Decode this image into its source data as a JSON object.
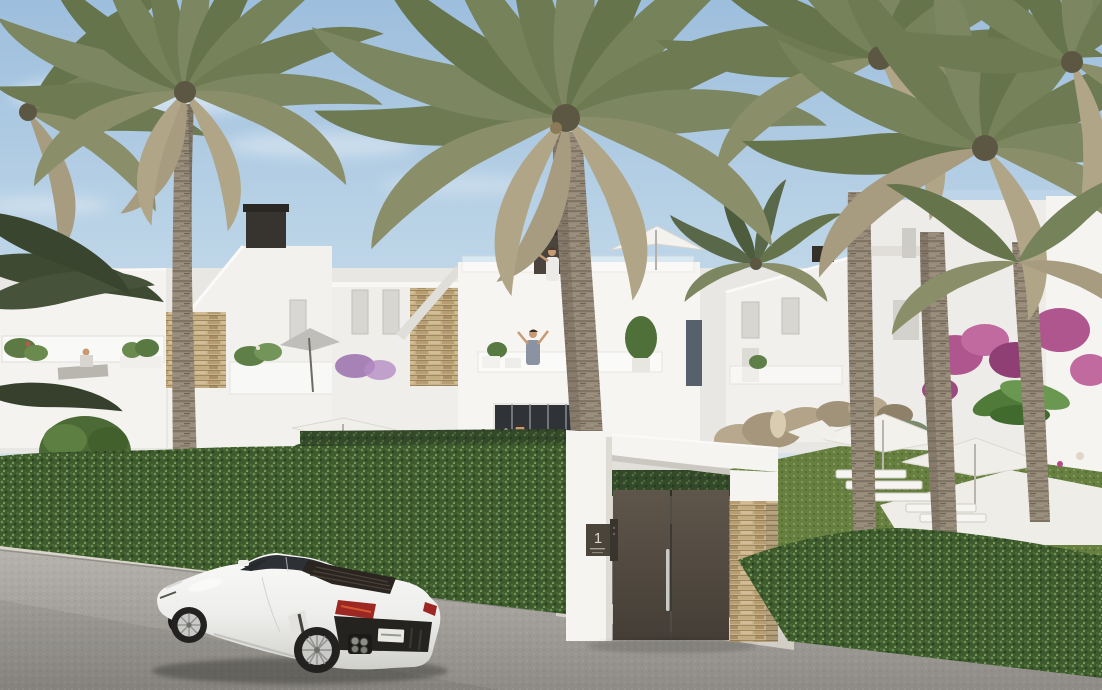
{
  "scene": {
    "kind": "residential-exterior-render",
    "objects": [
      "sky",
      "clouds",
      "palm-trees",
      "white-townhouses",
      "roof-terraces",
      "balconies",
      "street-hedge",
      "entrance-gate",
      "stone-pillar",
      "garden-with-umbrellas",
      "lawn",
      "bougainvillea",
      "road",
      "curb",
      "white-sports-car",
      "people-on-terraces"
    ]
  },
  "gate": {
    "plaque_number": "1"
  },
  "car": {
    "color_label": "white",
    "type_label": "sports-coupe"
  },
  "palette": {
    "sky_top": "#9dbedd",
    "sky_horizon": "#d9e4ea",
    "building_white": "#f4f3f0",
    "stone_accent": "#c7b189",
    "hedge_green": "#3e5a2f",
    "lawn_green": "#677f41",
    "palm_frond": "#75825a",
    "palm_trunk": "#9a8e7c",
    "road": "#a3a09b",
    "curb": "#d9d5cb",
    "gate_door": "#53493f",
    "plaque": "#4b443b",
    "intercom": "#3a342e",
    "tail_light": "#9c2723",
    "car_body": "#f2f2f0"
  }
}
